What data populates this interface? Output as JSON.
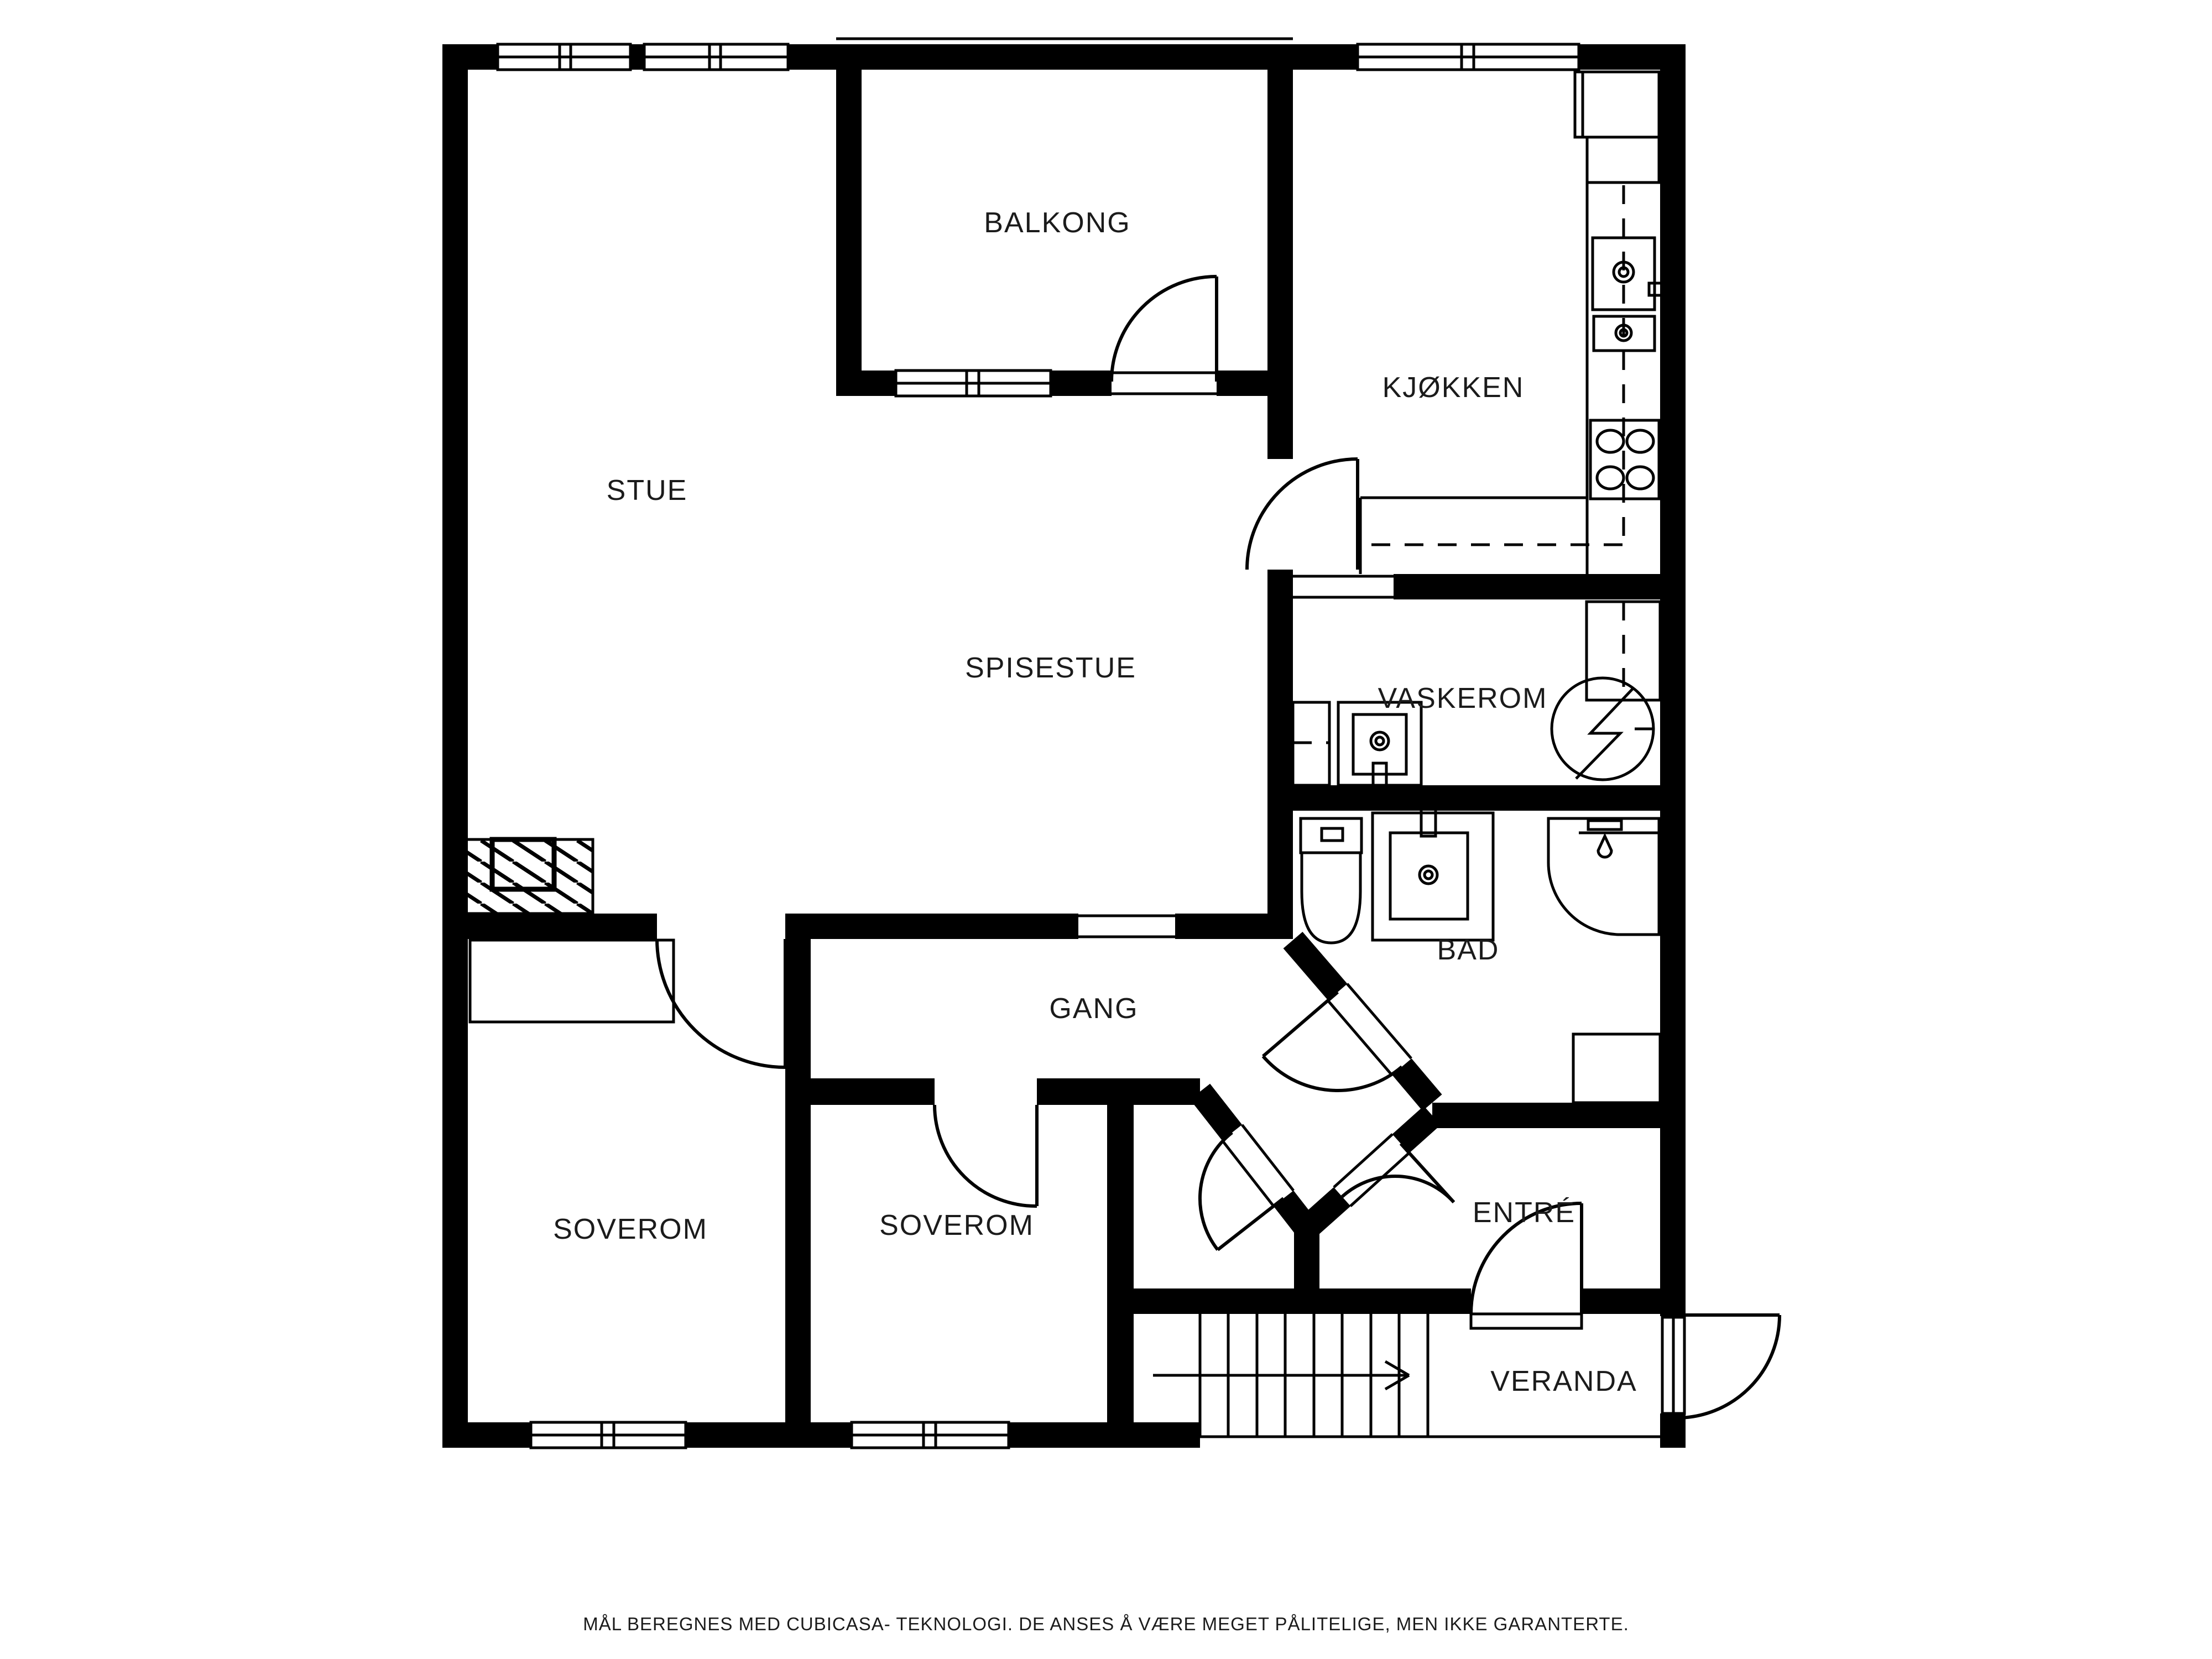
{
  "floorplan": {
    "rooms": [
      {
        "name": "BALKONG"
      },
      {
        "name": "STUE"
      },
      {
        "name": "KJØKKEN"
      },
      {
        "name": "SPISESTUE"
      },
      {
        "name": "VASKEROM"
      },
      {
        "name": "BAD"
      },
      {
        "name": "GANG"
      },
      {
        "name": "SOVEROM"
      },
      {
        "name": "SOVEROM"
      },
      {
        "name": "ENTRÉ"
      },
      {
        "name": "VERANDA"
      }
    ],
    "footer": {
      "disclaimer": "MÅL BEREGNES MED CUBICASA- TEKNOLOGI. DE ANSES Å VÆRE MEGET PÅLITELIGE, MEN IKKE GARANTERTE."
    }
  }
}
